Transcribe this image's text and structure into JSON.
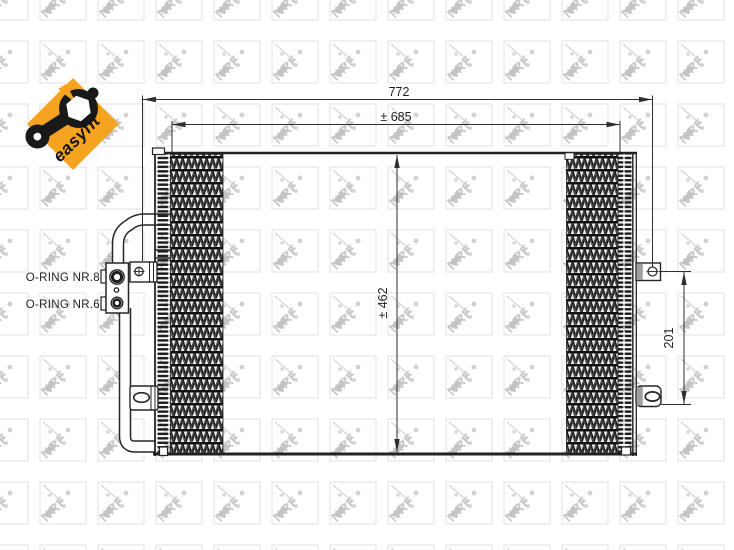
{
  "badge": {
    "label": "easyfit"
  },
  "watermark": {
    "brand": "NRF"
  },
  "drawing": {
    "dimensions": {
      "overall_width": "772",
      "core_width": "± 685",
      "core_height": "± 462",
      "bracket_pitch": "201"
    },
    "labels": {
      "oring_8": "O-RING NR.8",
      "oring_6": "O-RING NR.6"
    }
  },
  "colors": {
    "badge_orange": "#F6A41F",
    "drawing_line": "#262626",
    "watermark_gray": "#c6c6c6"
  }
}
